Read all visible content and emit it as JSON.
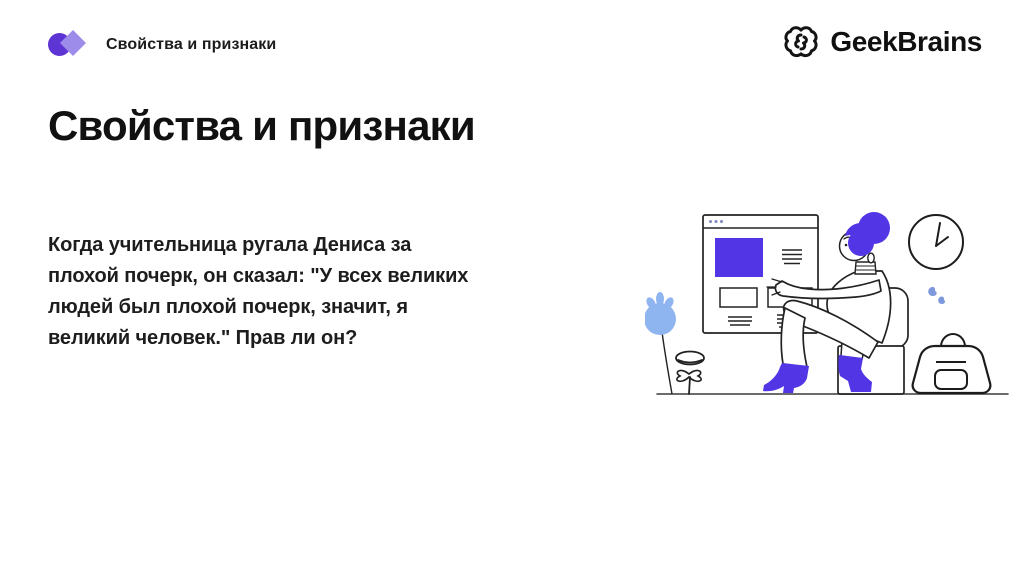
{
  "header": {
    "topic_label": "Свойства и признаки",
    "brand_name": "GeekBrains"
  },
  "main": {
    "title": "Свойства и признаки",
    "question_lines": [
      "Когда учительница ругала Дениса за",
      "плохой почерк, он сказал: \"У всех великих",
      "людей был плохой почерк, значит, я",
      "великий человек.\" Прав ли он?"
    ]
  },
  "icons": {
    "topic_marker": "circle-diamond-logo",
    "brand_logo": "brain-icon"
  },
  "illustration": {
    "description": "Line-art: person with purple bun hair sitting on a chair in front of a large browser window, wall clock above, sparkles, backpack, blue plant and small plant on a ground line",
    "elements": [
      "browser-window",
      "sitting-person",
      "chair",
      "wall-clock",
      "sparkles",
      "backpack",
      "blue-plant",
      "small-plant",
      "ground-line"
    ]
  },
  "colors": {
    "accent_purple": "#5236e6",
    "logo_circle": "#5c35d4",
    "logo_diamond": "#9d8cea",
    "plant_blue": "#8fb5f0",
    "sparkle_blue": "#7d98dc",
    "outline": "#222222",
    "ink": "#1d1d1d",
    "background": "#ffffff"
  }
}
